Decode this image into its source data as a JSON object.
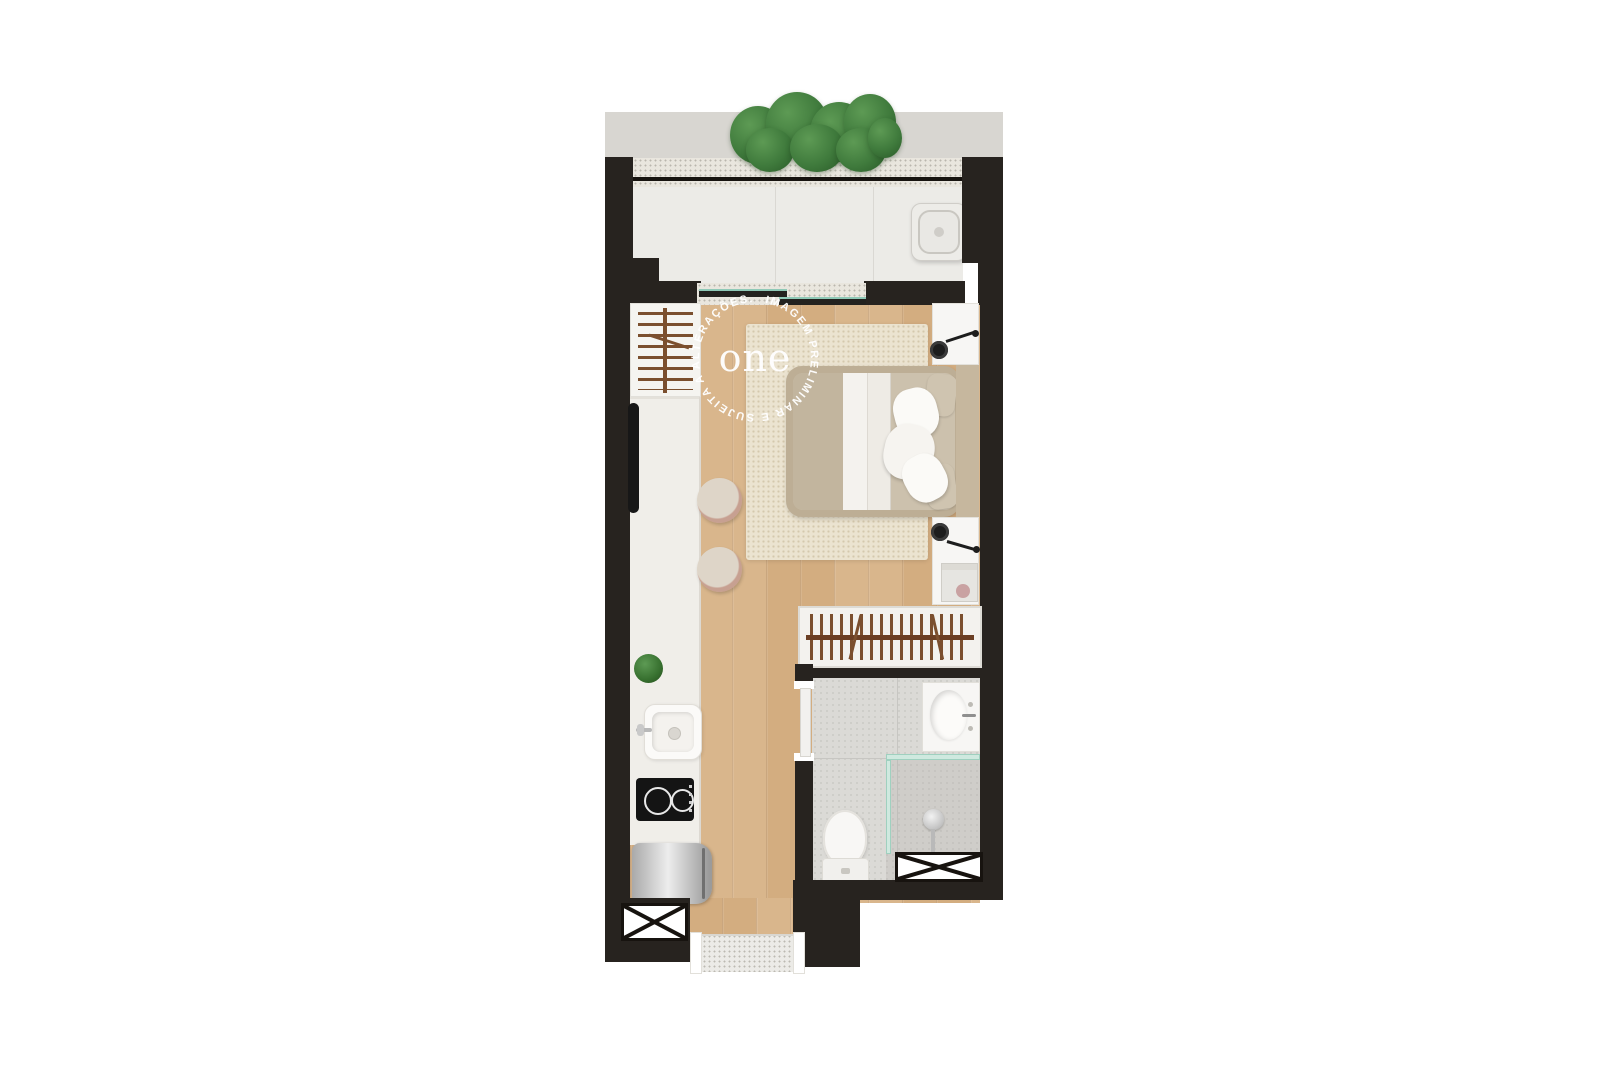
{
  "watermark": {
    "ring_text": "IMAGEM PRELIMINAR E SUJEITA A ALTERAÇÕES.  ",
    "logo_text": "one"
  },
  "palette": {
    "background": "#ffffff",
    "wall": "#27231f",
    "wood": "#d9b68c",
    "balcony-floor": "#ecebe7",
    "ledge": "#d8d6d1",
    "terrazzo": "#e9e6de",
    "counter": "#f0eee9",
    "rug": "#ebe3d0",
    "bed-frame": "#bdae95",
    "bed-duvet": "#ccc1ad",
    "bed-blanket": "#f4f2ee",
    "tile": "#dbdad6",
    "fixture-white": "#f7f6f4",
    "rod-brown": "#7b4f2e",
    "plant-green": "#3f7a3c",
    "plant-green-dark": "#2c5d2a",
    "glass": "#cfe9df",
    "steel": "#c6c6c6",
    "stool": "#ded5c8",
    "stool-ring": "#c7a091",
    "lamp-black": "#1d1d1d"
  },
  "fixtures": {
    "planter": "green-hedge-planter",
    "ac_unit": "ac-condenser-unit",
    "balcony_door": "sliding-glass-door",
    "wardrobe_rack": "open-wardrobe-hanger-rack",
    "tv": "wall-mounted-tv",
    "kitchen_counter": "kitchen-counter",
    "counter_stools": "counter-stool",
    "counter_plant": "potted-plant",
    "kitchen_sink": "kitchen-sink",
    "cooktop": "two-burner-cooktop",
    "fridge": "refrigerator",
    "bed": "double-bed",
    "rug": "area-rug",
    "nightstands": "nightstand-with-wall-lamp",
    "closet_rack": "closet-hanger-rack",
    "bathroom_door": "sliding-door",
    "vanity": "bathroom-vanity-sink",
    "glass_partition": "shower-glass-partition",
    "shower": "shower-head",
    "toilet": "toilet",
    "shafts": "ventilation-shaft",
    "entrance_mat": "entrance-doormat"
  }
}
